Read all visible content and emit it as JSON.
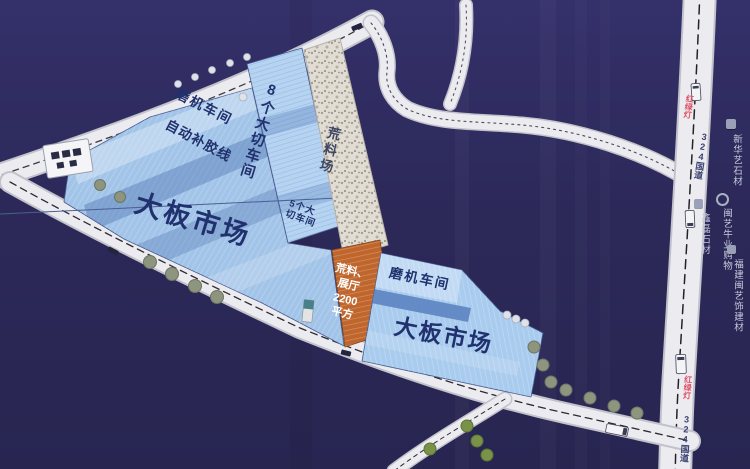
{
  "buildings": {
    "grinder_left": "磨机车间",
    "glue_line": "自动补胶线",
    "slab_market_left": "大板市场",
    "cutting_8": "8个大切车间",
    "cutting_5_line1": "5个大",
    "cutting_5_line2": "切车间",
    "raw_yard": "荒料场",
    "exhibit_lines": [
      "荒料、",
      "展厅",
      "2200",
      "平方"
    ],
    "grinder_right": "磨机车间",
    "slab_market_right": "大板市场"
  },
  "roads": {
    "national_road": "324国道",
    "signal": "红绿灯"
  },
  "poi": [
    {
      "name": "新华艺石材",
      "icon": "building-icon"
    },
    {
      "name": "鑫磊石材",
      "icon": "building-icon"
    },
    {
      "name": "闽艺牛业购物",
      "icon": "circle-badge-icon"
    },
    {
      "name": "福建闽艺饰建材",
      "icon": "building-icon"
    }
  ],
  "colors": {
    "background": "#2c295b",
    "road": "#ececf0",
    "building_blue": "#a6c8ea",
    "building_orange": "#bf662e",
    "raw_yard": "#e2ddd4",
    "label_navy": "#20316e",
    "signal_red": "#e04e66",
    "poi_text": "#c6cbdc"
  }
}
